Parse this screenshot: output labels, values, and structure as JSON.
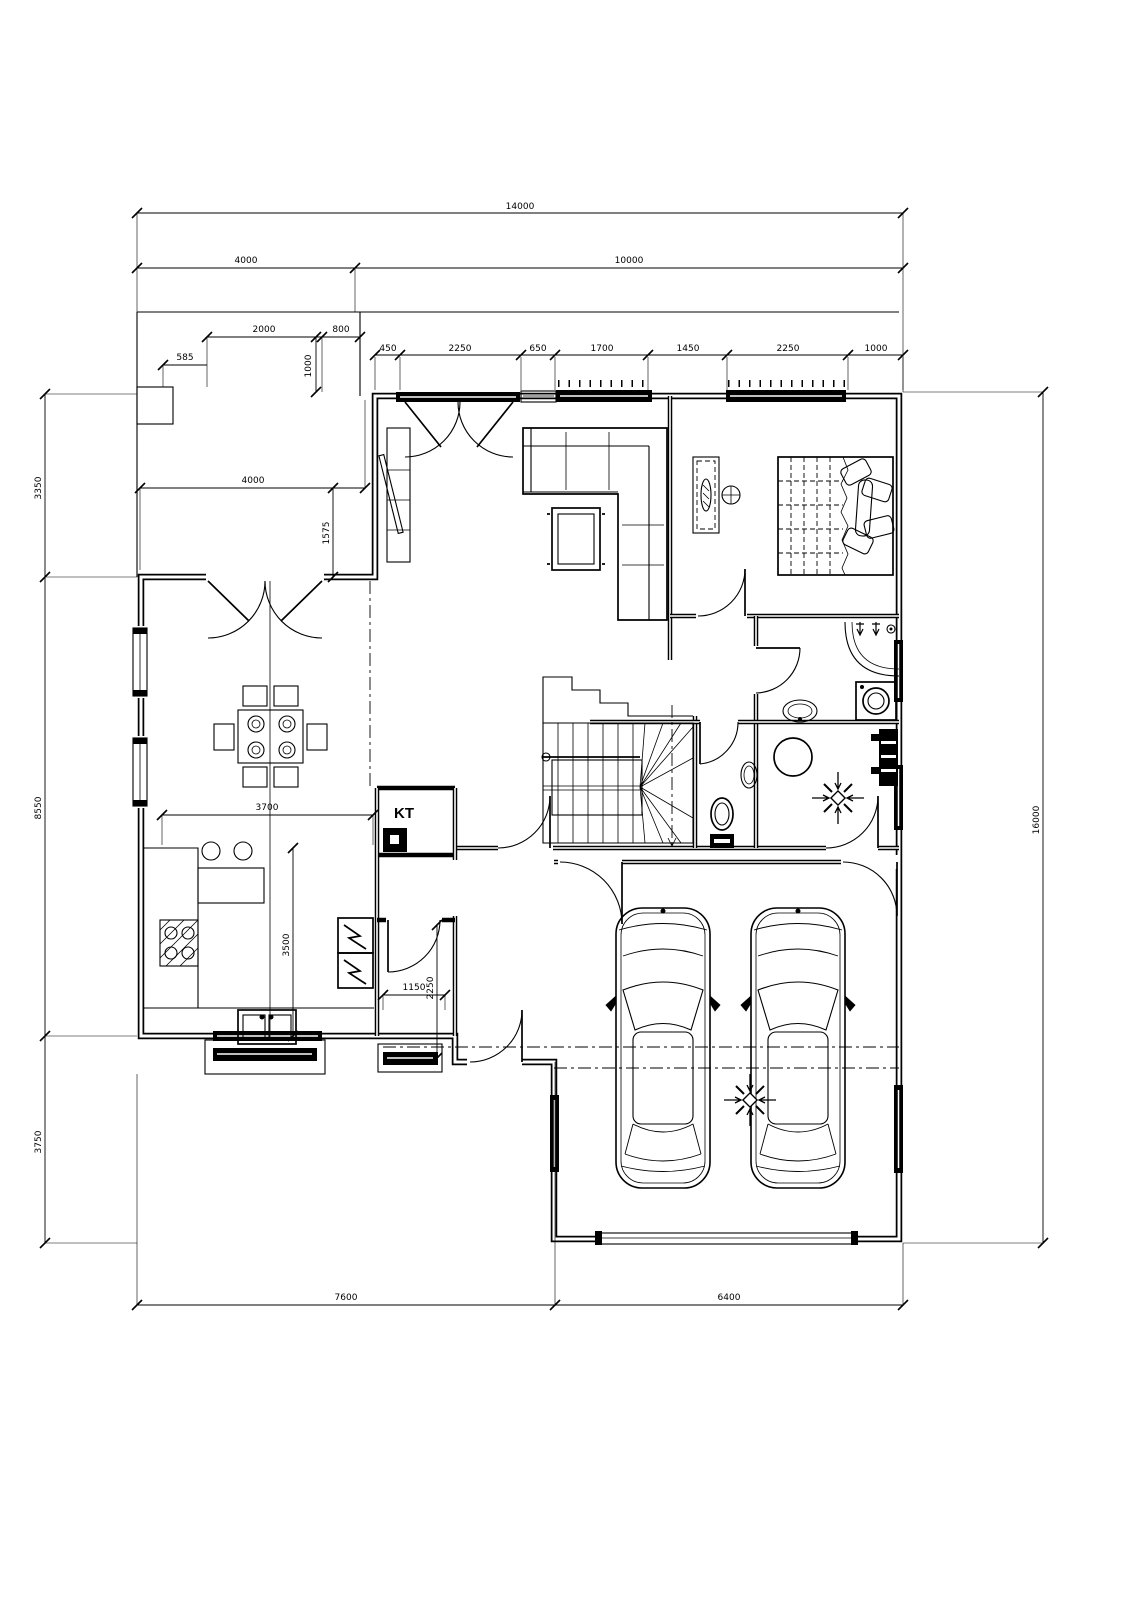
{
  "drawing": {
    "room_labels": {
      "kt": "KT"
    },
    "dimensions": {
      "top_total": "14000",
      "top_left": "4000",
      "top_right": "10000",
      "terrace_door": "2000",
      "terrace_side": "800",
      "terrace_offset": "585",
      "terrace_return": "1000",
      "terrace_width": "4000",
      "terrace_depth": "1575",
      "window_row": [
        "450",
        "2250",
        "650",
        "1700",
        "1450",
        "2250",
        "1000"
      ],
      "left_chain": [
        "3350",
        "8550",
        "3750"
      ],
      "right_total": "16000",
      "bottom_left": "7600",
      "bottom_right": "6400",
      "kitchen_width": "3700",
      "kitchen_depth": "3500",
      "corridor_width": "1150",
      "corridor_depth": "2250"
    },
    "colors": {
      "ink": "#000000",
      "paper": "#ffffff"
    }
  }
}
